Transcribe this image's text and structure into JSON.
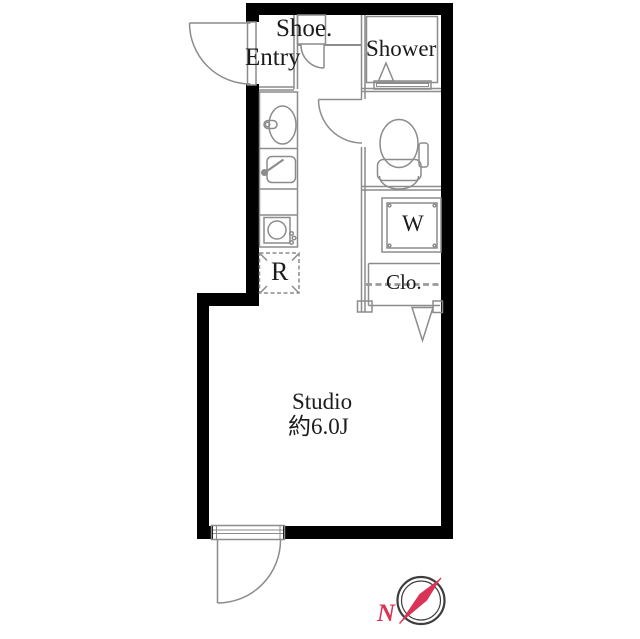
{
  "floor_plan": {
    "labels": {
      "shoe": "Shoe.",
      "entry": "Entry",
      "shower": "Shower",
      "washer": "W",
      "closet": "Clo.",
      "refrigerator": "R",
      "room_name": "Studio",
      "room_size": "約6.0J",
      "compass_north": "N"
    },
    "colors": {
      "wall": "#000000",
      "thin_line": "#8c8c8c",
      "dash_line": "#9a9a9a",
      "text": "#1c1c1c",
      "compass_ring": "#3d3d3d",
      "compass_needle": "#d93355",
      "background": "#ffffff"
    }
  }
}
